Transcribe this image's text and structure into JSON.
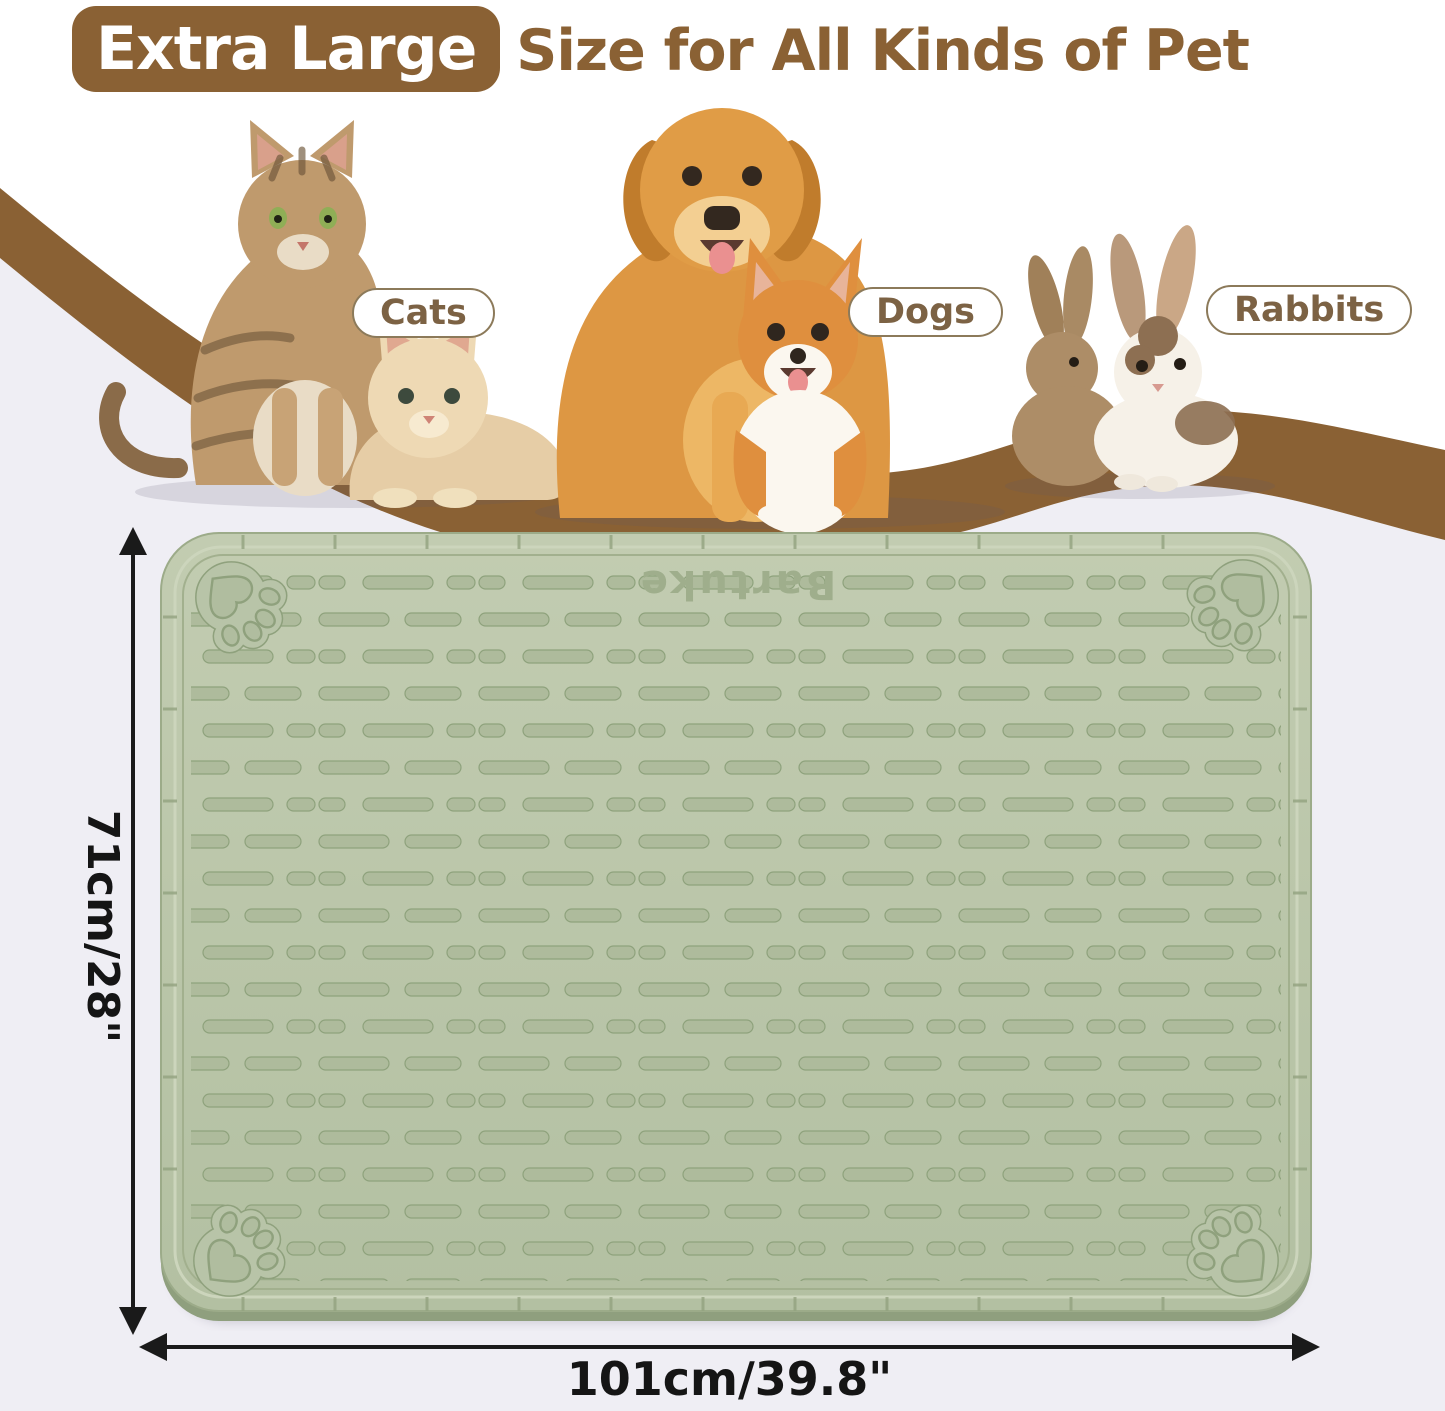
{
  "title": {
    "badge_label": "Extra Large",
    "headline": "Size for All Kinds of Pet"
  },
  "pet_labels": {
    "cats": "Cats",
    "dogs": "Dogs",
    "rabbits": "Rabbits"
  },
  "mat": {
    "brand": "Bartuke",
    "height_dimension": "71cm/28\"",
    "width_dimension": "101cm/39.8\""
  },
  "colors": {
    "accent_brown": "#8a6134",
    "pill_text_brown": "#7c6244",
    "mat_green": "#bac6aa",
    "mat_groove_green": "#8ea27c",
    "background_lavender": "#efeef4",
    "dimension_text": "#151515"
  }
}
